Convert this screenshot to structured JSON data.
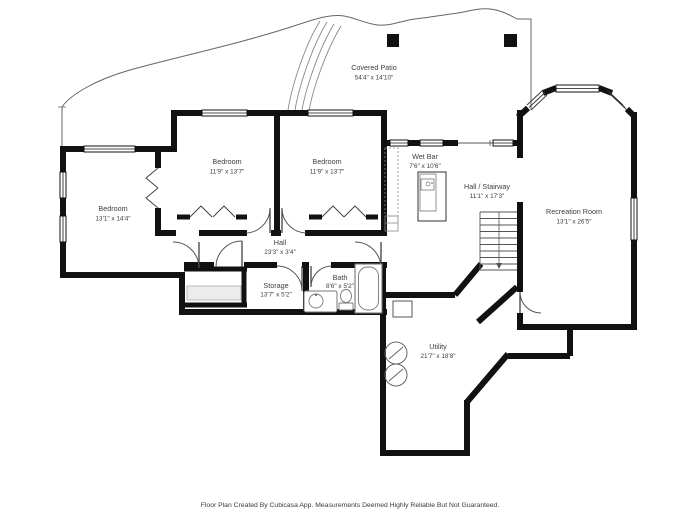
{
  "document": {
    "type": "floor-plan",
    "footer": "Floor Plan Created By Cubicasa App. Measurements Deemed Highly Reliable But Not Guaranteed."
  },
  "colors": {
    "wall": "#111111",
    "thin_line": "#666666",
    "fixture_line": "#777777",
    "shelf_fill": "#ececec",
    "label_text": "#3d3d3d",
    "background": "#ffffff"
  },
  "rooms": [
    {
      "id": "covered-patio",
      "name": "Covered Patio",
      "dims": "54'4\" x 14'10\""
    },
    {
      "id": "bedroom-left",
      "name": "Bedroom",
      "dims": "13'1\" x 14'4\""
    },
    {
      "id": "bedroom-middle",
      "name": "Bedroom",
      "dims": "11'9\" x 13'7\""
    },
    {
      "id": "bedroom-right",
      "name": "Bedroom",
      "dims": "11'9\" x 13'7\""
    },
    {
      "id": "wet-bar",
      "name": "Wet Bar",
      "dims": "7'6\" x 10'6\""
    },
    {
      "id": "hall-stairway",
      "name": "Hall / Stairway",
      "dims": "11'1\" x 17'3\""
    },
    {
      "id": "recreation-room",
      "name": "Recreation Room",
      "dims": "13'1\" x 26'5\""
    },
    {
      "id": "hall",
      "name": "Hall",
      "dims": "23'3\" x 3'4\""
    },
    {
      "id": "storage",
      "name": "Storage",
      "dims": "13'7\" x 5'2\""
    },
    {
      "id": "bath",
      "name": "Bath",
      "dims": "8'6\" x 5'2\""
    },
    {
      "id": "utility",
      "name": "Utility",
      "dims": "21'7\" x 18'8\""
    }
  ]
}
